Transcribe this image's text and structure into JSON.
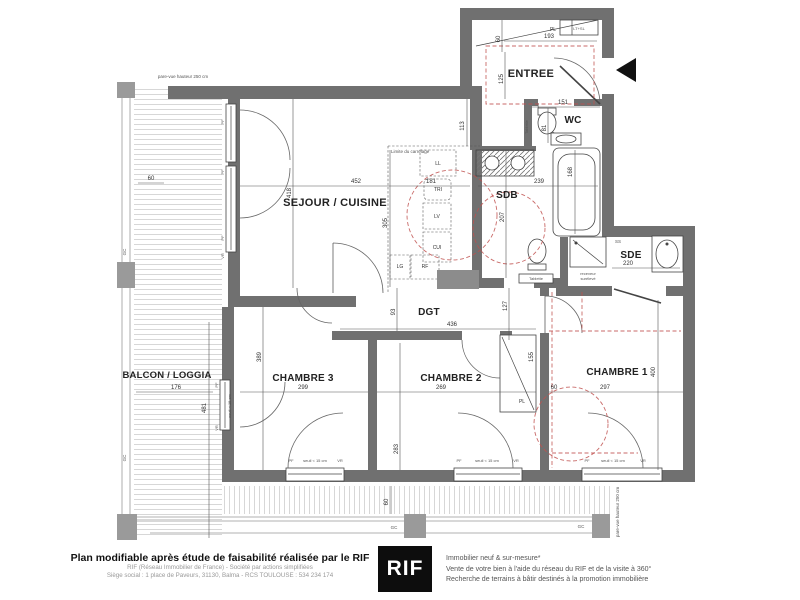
{
  "colors": {
    "wall": "#707070",
    "accent_red": "#c0504d",
    "logo_bg": "#0d0d0d"
  },
  "plan": {
    "rooms": {
      "sejour": "SEJOUR / CUISINE",
      "entree": "ENTREE",
      "wc": "WC",
      "sdb": "SDB",
      "sde": "SDE",
      "dgt": "DGT",
      "balcon": "BALCON / LOGGIA",
      "ch1": "CHAMBRE 1",
      "ch2": "CHAMBRE 2",
      "ch3": "CHAMBRE 3"
    },
    "dims": {
      "sejour_w": "452",
      "sejour_h": "418",
      "d113": "113",
      "d305": "305",
      "d181": "181",
      "entree_60": "60",
      "entree_w": "193",
      "entree_h": "125",
      "wc_w": "151",
      "wc_h": "81",
      "bain": "168",
      "sdb_w": "239",
      "sdb_h": "207",
      "sde_w": "220",
      "dgt_h": "93",
      "dgt_w": "436",
      "d127": "127",
      "ch3_h": "389",
      "ch3_w": "299",
      "ch2_h": "283",
      "ch2_w": "269",
      "pl_h": "155",
      "pl_w": "60",
      "ch1_w": "297",
      "ch1_h": "400",
      "balcon_w": "176",
      "balcon_h": "481",
      "balcon_60": "60",
      "terrasse_60": "60"
    },
    "fixtures": {
      "pl": "PL",
      "ltsl": "LT+SL",
      "tablette": "Tablette",
      "ll": "LL",
      "tri": "TRI",
      "lv": "LV",
      "cui": "CUI",
      "lg": "LG",
      "rf": "RF",
      "ss": "SS",
      "receveur_1": "receveur",
      "receveur_2": "surélevé",
      "pl2": "PL"
    },
    "annotations": {
      "pare_vue": "pare-vue hauteur 250 cm",
      "limite": "Limite du carrelage",
      "seuil": "seuil < 15 cm",
      "pf": "PF",
      "vr": "VR",
      "gc": "GC"
    }
  },
  "footer": {
    "title": "Plan modifiable après étude de faisabilité réalisée par le RIF",
    "line2": "RIF (Réseau Immobilier de France) - Société par actions simplifiées",
    "line3": "Siège social : 1 place de Paveurs, 31130, Balma - RCS TOULOUSE : 534 234 174",
    "logo": "RIF",
    "right1": "Immobilier neuf & sur-mesure*",
    "right2": "Vente de votre bien à l'aide du réseau du RIF et de la visite à 360°",
    "right3": "Recherche de terrains à bâtir destinés à la promotion immobilière"
  }
}
